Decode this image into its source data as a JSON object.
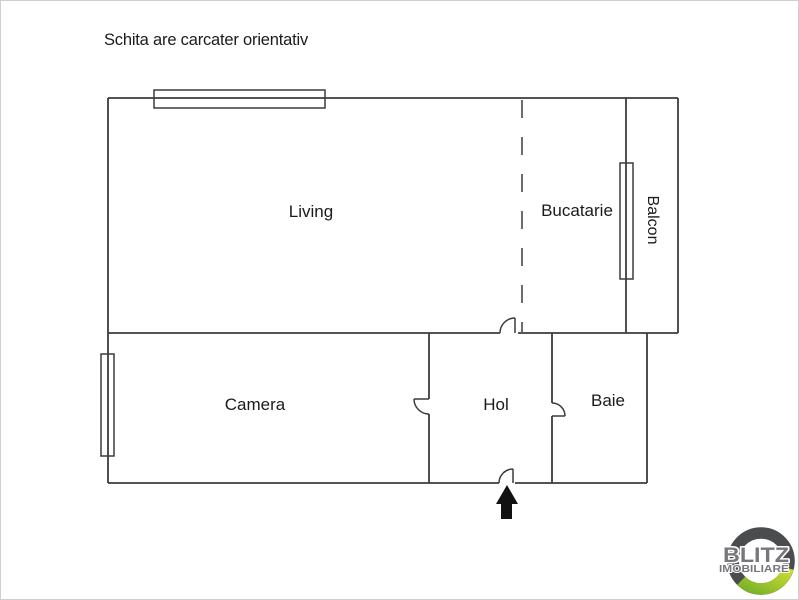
{
  "disclaimer": "Schita are carcater orientativ",
  "plan": {
    "rooms": [
      {
        "id": "living",
        "label": "Living"
      },
      {
        "id": "bucatarie",
        "label": "Bucatarie"
      },
      {
        "id": "balcon",
        "label": "Balcon"
      },
      {
        "id": "camera",
        "label": "Camera"
      },
      {
        "id": "hol",
        "label": "Hol"
      },
      {
        "id": "baie",
        "label": "Baie"
      }
    ],
    "features": [
      "window-top",
      "window-balcony",
      "window-camera",
      "dashed-partition-living-bucatarie",
      "door-living",
      "door-camera",
      "door-baie",
      "entrance-door",
      "entrance-arrow"
    ],
    "colors": {
      "wall": "#3c3c3c",
      "text": "#1b1b1b",
      "arrow": "#111111",
      "background": "#ffffff"
    }
  },
  "logo": {
    "brand": "BLITZ",
    "subtitle": "IMOBILIARE",
    "colors": {
      "ring": "#4b4c4e",
      "green_dark": "#79b229",
      "green_light": "#cede31",
      "text": "#76777a"
    }
  }
}
